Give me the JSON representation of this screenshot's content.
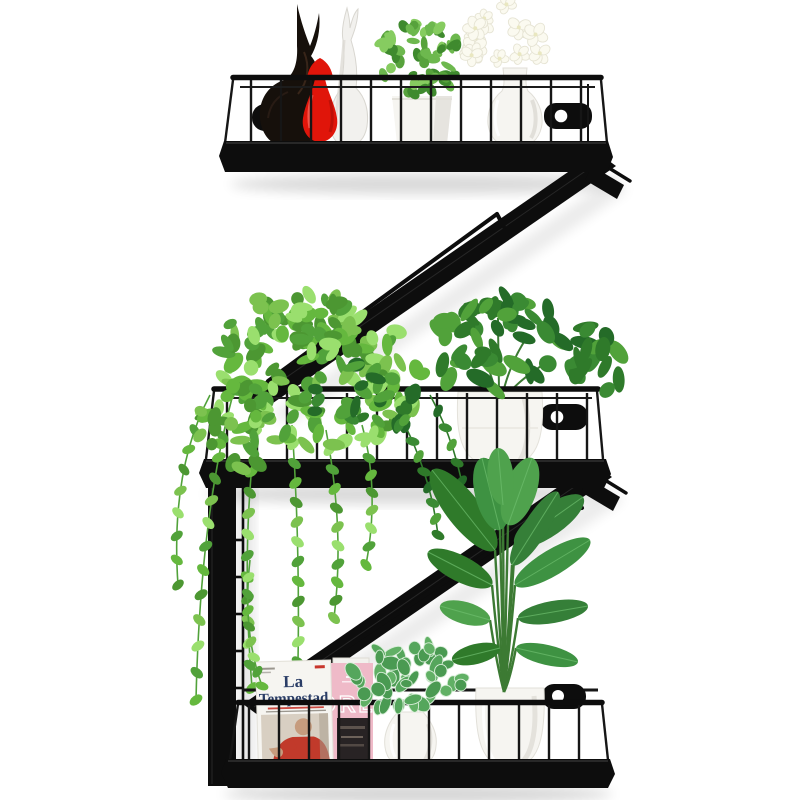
{
  "page": {
    "background": "#ffffff",
    "description": "Product photo: black metal Z-shaped 3-tier wall-mounted floating shelf decorated with plants, vases, figurines, white flowers and magazines on a white wall"
  },
  "colors": {
    "metal": "#0d0d0d",
    "metal_soft": "#1a1a1a",
    "metal_highlight": "#3c3c3c",
    "ceramic_white": "#f6f5f1",
    "ceramic_shade": "#d9d6cf",
    "red_vase": "#e0150a",
    "red_vase_dark": "#a50d05",
    "black_figurine": "#16100b",
    "white_figurine": "#f2f1ee",
    "flower_white": "#fbfaf0",
    "flower_edge": "#e6e4d4",
    "flower_center": "#e9e7c0",
    "green_bright": "#7cc24f",
    "green_light": "#9adf6e",
    "green_mid": "#51a23a",
    "green_dark": "#2f7a2a",
    "green_deep": "#246b28",
    "stem_green": "#3c7a33",
    "magazine_cover": "#f6f5f1",
    "magazine_title": "#2a3d66",
    "magazine_accent_red": "#c8372d",
    "text_gray": "#9a968e",
    "photo_beige": "#d8cfc2",
    "skin": "#c69c7e",
    "sweater_red": "#c13a2b",
    "book_pink": "#efbac8",
    "book_photo_dark": "#282324"
  },
  "magazine": {
    "title_line1": "La",
    "title_line2": "Tempestad"
  },
  "pink_book": {
    "visible_title": "ORLD"
  },
  "shelf_unit": {
    "shape": "Z",
    "tiers": [
      {
        "name": "top-shelf",
        "items": [
          "black deer figurine",
          "red teardrop vase",
          "white deer figurine",
          "green plant in white square pot",
          "white flower bouquet in white vase"
        ]
      },
      {
        "name": "middle-shelf",
        "items": [
          "trailing green plant",
          "green plant in round white pot"
        ]
      },
      {
        "name": "bottom-shelf",
        "items": [
          "La Tempestad magazine",
          "pink book",
          "nerve plant in white vase",
          "tall leafy plant in white pot"
        ]
      }
    ]
  }
}
